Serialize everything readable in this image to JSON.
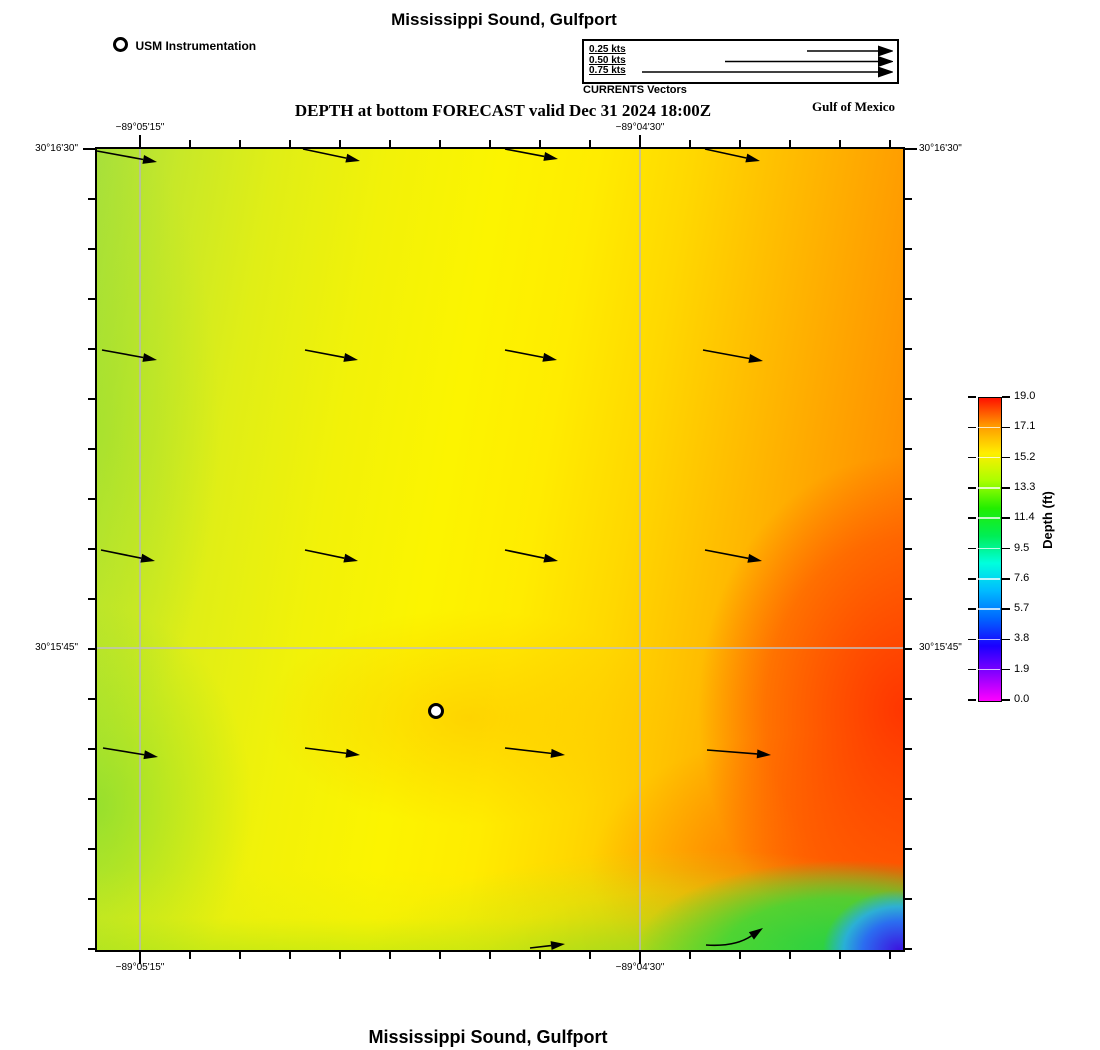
{
  "titles": {
    "top": "Mississippi Sound, Gulfport",
    "bottom": "Mississippi Sound, Gulfport",
    "forecast": "DEPTH at bottom FORECAST valid Dec 31 2024 18:00Z",
    "region": "Gulf of Mexico"
  },
  "legend": {
    "station_label": "USM Instrumentation",
    "vectors_caption": "CURRENTS Vectors",
    "entries": [
      {
        "label": "0.25 kts",
        "shaft_start_px": 223
      },
      {
        "label": "0.50 kts",
        "shaft_start_px": 141
      },
      {
        "label": "0.75 kts",
        "shaft_start_px": 58
      }
    ],
    "shaft_end_px": 294,
    "row_y_px": [
      10,
      20.5,
      31
    ]
  },
  "chart_data": {
    "type": "heatmap",
    "title": "DEPTH at bottom FORECAST valid Dec 31 2024 18:00Z",
    "subtitle": "Mississippi Sound, Gulfport",
    "region_label": "Gulf of Mexico",
    "colormap": "rainbow (magenta-blue-cyan-green-yellow-orange-red)",
    "plot_area_px": {
      "left": 97,
      "top": 149,
      "width": 806,
      "height": 801
    },
    "x_axis": {
      "labeled_ticks": [
        {
          "label": "−89°05'15\"",
          "px": 43
        },
        {
          "label": "−89°04'30\"",
          "px": 543
        }
      ],
      "minor_tick_start_px": 43,
      "minor_tick_spacing_px": 50,
      "minor_tick_count": 16
    },
    "y_axis": {
      "labeled_ticks": [
        {
          "label": "30°16'30\"",
          "px": 0
        },
        {
          "label": "30°15'45\"",
          "px": 499
        }
      ],
      "minor_tick_start_px": 0,
      "minor_tick_spacing_px": 50,
      "minor_tick_count": 17
    },
    "gridlines": {
      "vertical_px": [
        43,
        543
      ],
      "horizontal_px": [
        499
      ]
    },
    "colorbar": {
      "label": "Depth (ft)",
      "min": 0.0,
      "max": 19.0,
      "tick_labels_top_to_bottom": [
        "19.0",
        "17.1",
        "15.2",
        "13.3",
        "11.4",
        "9.5",
        "7.6",
        "5.7",
        "3.8",
        "1.9",
        "0.0"
      ],
      "stops_bottom_to_top": [
        "#ff00ff",
        "#8800ff",
        "#1a00ff",
        "#0066ff",
        "#00bbff",
        "#00ffdd",
        "#00ee55",
        "#22ee00",
        "#aaff00",
        "#ffee00",
        "#ff9900",
        "#ff1100"
      ]
    },
    "station_marker": {
      "x_px": 339,
      "y_px": 562,
      "label": "USM Instrumentation"
    },
    "current_vectors_px": [
      {
        "x1": 0,
        "y1": 2,
        "x2": 60,
        "y2": 13
      },
      {
        "x1": 206,
        "y1": 0,
        "x2": 263,
        "y2": 12
      },
      {
        "x1": 408,
        "y1": 0,
        "x2": 461,
        "y2": 10
      },
      {
        "x1": 608,
        "y1": 0,
        "x2": 663,
        "y2": 12
      },
      {
        "x1": 5,
        "y1": 201,
        "x2": 60,
        "y2": 211
      },
      {
        "x1": 208,
        "y1": 201,
        "x2": 261,
        "y2": 211
      },
      {
        "x1": 408,
        "y1": 201,
        "x2": 460,
        "y2": 211
      },
      {
        "x1": 606,
        "y1": 201,
        "x2": 666,
        "y2": 212
      },
      {
        "x1": 4,
        "y1": 401,
        "x2": 58,
        "y2": 412
      },
      {
        "x1": 208,
        "y1": 401,
        "x2": 261,
        "y2": 412
      },
      {
        "x1": 408,
        "y1": 401,
        "x2": 461,
        "y2": 412
      },
      {
        "x1": 608,
        "y1": 401,
        "x2": 665,
        "y2": 412
      },
      {
        "x1": 6,
        "y1": 599,
        "x2": 61,
        "y2": 608
      },
      {
        "x1": 208,
        "y1": 599,
        "x2": 263,
        "y2": 606
      },
      {
        "x1": 408,
        "y1": 599,
        "x2": 468,
        "y2": 606
      },
      {
        "x1": 610,
        "y1": 601,
        "x2": 674,
        "y2": 606
      },
      {
        "x1": 433,
        "y1": 799,
        "x2": 468,
        "y2": 795
      },
      {
        "x1": 609,
        "y1": 796,
        "cx": 638,
        "cy": 798,
        "x2": 666,
        "y2": 779,
        "curve": true
      }
    ],
    "approx_depth_ft_samples": {
      "note": "depth values read from color field; rows top to bottom, columns left to right",
      "column_x_px": [
        100,
        300,
        500,
        700,
        880
      ],
      "row_y_px": [
        200,
        400,
        600,
        800,
        930
      ],
      "values_ft": [
        [
          14.0,
          14.9,
          15.3,
          16.3,
          17.3
        ],
        [
          13.9,
          14.9,
          15.3,
          16.6,
          17.6
        ],
        [
          13.8,
          14.8,
          15.4,
          16.9,
          18.4
        ],
        [
          13.6,
          14.9,
          15.6,
          17.2,
          18.6
        ],
        [
          13.0,
          14.3,
          15.0,
          12.5,
          4.0
        ]
      ]
    }
  }
}
